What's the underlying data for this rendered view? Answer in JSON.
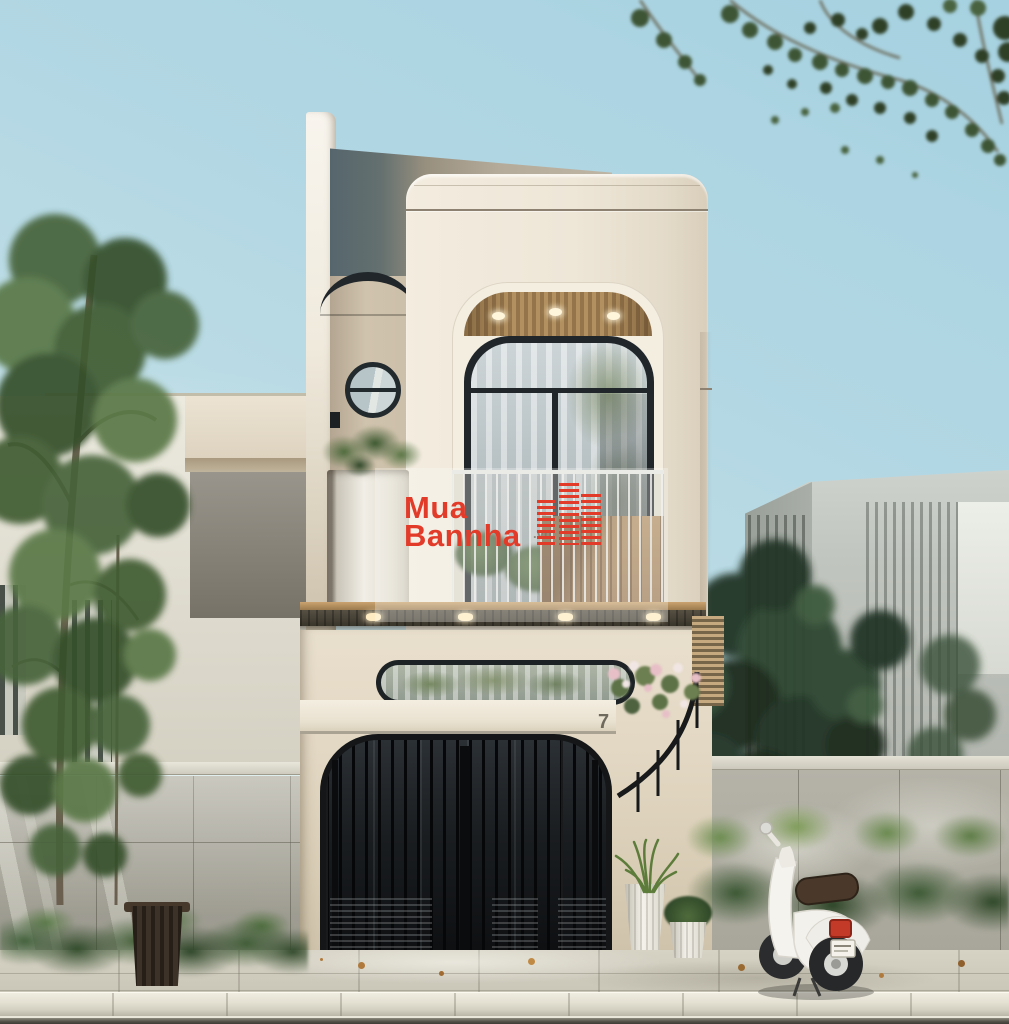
{
  "watermark": {
    "brand_line1": "Mua",
    "brand_line2": "Bannha",
    "brand_suffix": ".vn",
    "brand_color": "#e23b2a"
  },
  "house": {
    "street_number": "7"
  },
  "palette": {
    "sky_top": "#a6d1e0",
    "sky_low": "#d8eae9",
    "facade": "#efe8da",
    "facade_shade": "#d8cdbb",
    "roof_side_gray": "#56666d",
    "roof_top_warm": "#b5ab9b",
    "window_frame": "#20262a",
    "soffit_wood": "#a98a5f",
    "balcony_screen_wood": "#b48c5e",
    "gate_metal": "#17191b",
    "stone_wall": "#b4b2a7",
    "wall_cap": "#dcd9cf",
    "sidewalk": "#d2cec1",
    "curb": "#eae7db",
    "street": "#524f47",
    "foliage": "#4c663b",
    "foliage_dark": "#27392a",
    "planter_white": "#f1eee6",
    "scooter_body": "#f3f2ed",
    "scooter_seat": "#4a392b",
    "tail_light": "#c33a28",
    "trash_bin": "#30271e"
  }
}
